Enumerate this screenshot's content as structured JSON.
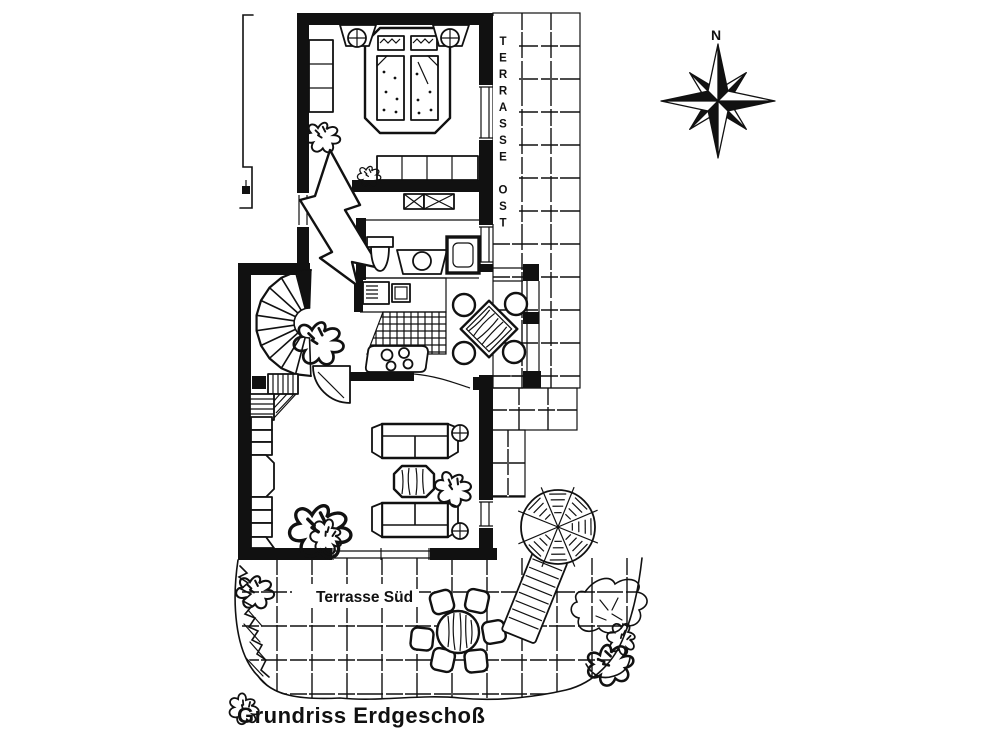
{
  "title": "Grundriss Erdgeschoß",
  "labels": {
    "terrace_east": "TERRASSE OST",
    "terrace_south": "Terrasse Süd",
    "compass_north": "N"
  },
  "colors": {
    "ink": "#111111",
    "paper": "#ffffff"
  }
}
